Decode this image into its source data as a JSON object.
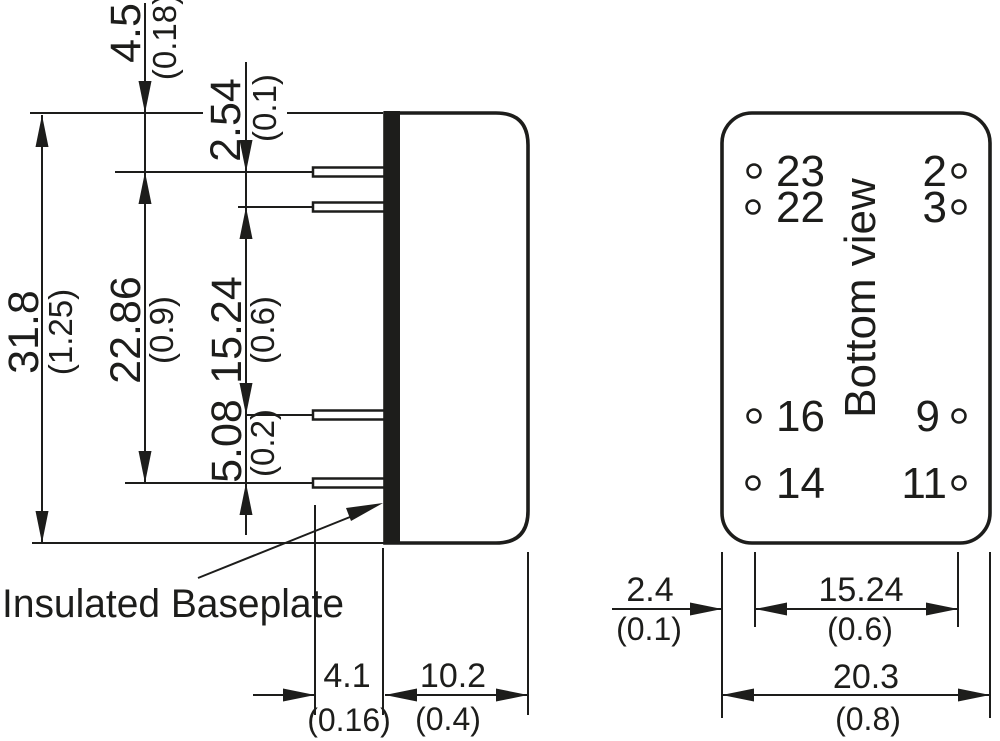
{
  "drawing": {
    "colors": {
      "ink": "#1d1d1b",
      "background": "#ffffff"
    },
    "side_view": {
      "label": "Insulated Baseplate",
      "dims": {
        "body_height": {
          "mm": "31.8",
          "inch": "(1.25)"
        },
        "top_to_pin": {
          "mm": "4.5",
          "inch": "(0.18)"
        },
        "pin_gap_top": {
          "mm": "2.54",
          "inch": "(0.1)"
        },
        "pin_span": {
          "mm": "22.86",
          "inch": "(0.9)"
        },
        "pin_gap_mid": {
          "mm": "15.24",
          "inch": "(0.6)"
        },
        "pin_gap_bottom": {
          "mm": "5.08",
          "inch": "(0.2)"
        },
        "pin_length": {
          "mm": "4.1",
          "inch": "(0.16)"
        },
        "body_depth": {
          "mm": "10.2",
          "inch": "(0.4)"
        }
      }
    },
    "bottom_view": {
      "label": "Bottom view",
      "pins": [
        "23",
        "22",
        "2",
        "3",
        "16",
        "14",
        "9",
        "11"
      ],
      "dims": {
        "edge_to_pin": {
          "mm": "2.4",
          "inch": "(0.1)"
        },
        "pin_row_pitch": {
          "mm": "15.24",
          "inch": "(0.6)"
        },
        "body_width": {
          "mm": "20.3",
          "inch": "(0.8)"
        }
      }
    }
  }
}
